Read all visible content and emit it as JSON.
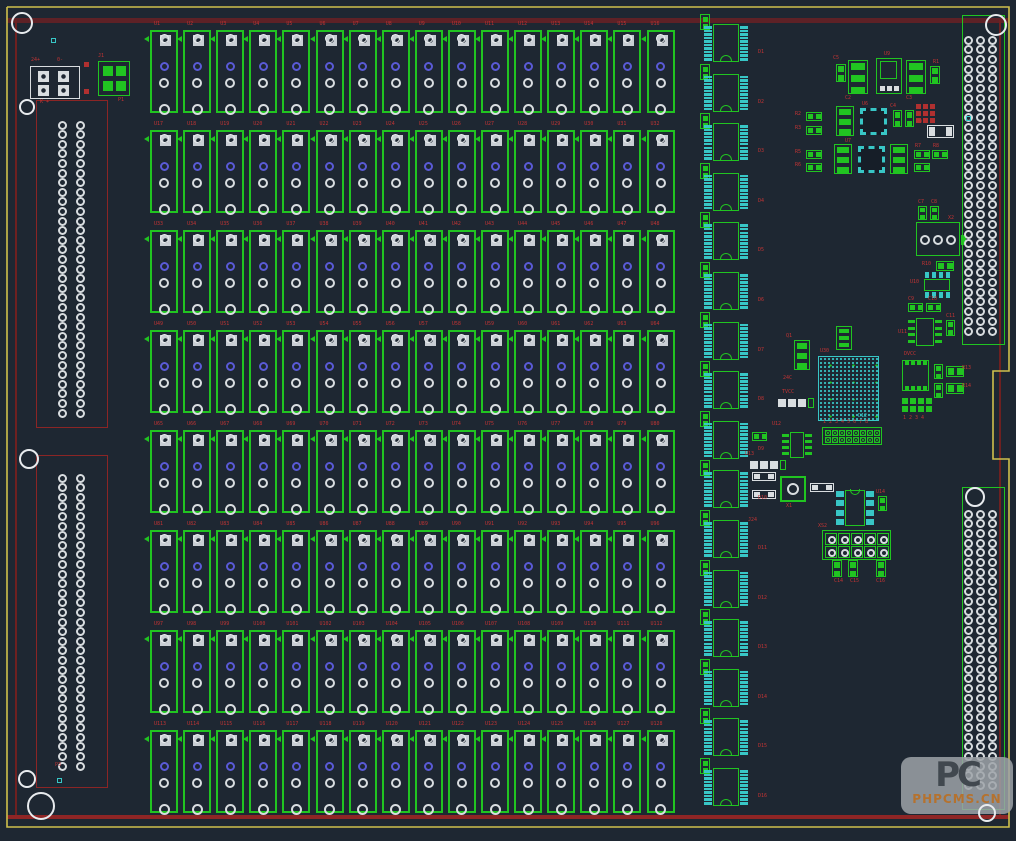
{
  "board": {
    "bg": "#1e2732",
    "outline_yellow": "#cfc04c",
    "outline_points": "7,7 1009,7 1009,371 993,371 993,459 1009,459 1009,827 7,827 7,7",
    "red_top": {
      "x": 7,
      "y": 18,
      "w": 1002,
      "h": 5,
      "color": "#5e2126"
    },
    "red_bottom": {
      "x": 7,
      "y": 815,
      "w": 1002,
      "h": 4,
      "color": "#8f2525"
    },
    "red_left": {
      "x": 15,
      "y": 20,
      "w": 2,
      "h": 795,
      "color": "#6e2020"
    },
    "red_right": {
      "x": 999,
      "y": 20,
      "w": 2,
      "h": 795,
      "color": "#6e2020"
    }
  },
  "colors": {
    "green": "#21c421",
    "cyan": "#38c6c6",
    "white": "#d9dde0",
    "blue": "#5a5ad6",
    "redline": "#8b2525",
    "label": "#c03434",
    "padgray": "#c9ced4"
  },
  "relays": {
    "x0": 150,
    "y0": 30,
    "dx": 33.1,
    "dy": 100,
    "w": 28,
    "h": 83,
    "cols": 16,
    "refs": [
      "U1",
      "U2",
      "U3",
      "U4",
      "U5",
      "U6",
      "U7",
      "U8",
      "U9",
      "U10",
      "U11",
      "U12",
      "U13",
      "U14",
      "U15",
      "U16",
      "U17",
      "U18",
      "U19",
      "U20",
      "U21",
      "U22",
      "U23",
      "U24",
      "U25",
      "U26",
      "U27",
      "U28",
      "U29",
      "U30",
      "U31",
      "U32",
      "U33",
      "U34",
      "U35",
      "U36",
      "U37",
      "U38",
      "U39",
      "U40",
      "U41",
      "U42",
      "U43",
      "U44",
      "U45",
      "U46",
      "U47",
      "U48",
      "U49",
      "U50",
      "U51",
      "U52",
      "U53",
      "U54",
      "U55",
      "U56",
      "U57",
      "U58",
      "U59",
      "U60",
      "U61",
      "U62",
      "U63",
      "U64",
      "U65",
      "U66",
      "U67",
      "U68",
      "U69",
      "U70",
      "U71",
      "U72",
      "U73",
      "U74",
      "U75",
      "U76",
      "U77",
      "U78",
      "U79",
      "U80",
      "U81",
      "U82",
      "U83",
      "U84",
      "U85",
      "U86",
      "U87",
      "U88",
      "U89",
      "U90",
      "U91",
      "U92",
      "U93",
      "U94",
      "U95",
      "U96",
      "U97",
      "U98",
      "U99",
      "U100",
      "U101",
      "U102",
      "U103",
      "U104",
      "U105",
      "U106",
      "U107",
      "U108",
      "U109",
      "U110",
      "U111",
      "U112",
      "U113",
      "U114",
      "U115",
      "U116",
      "U117",
      "U118",
      "U119",
      "U120",
      "U121",
      "U122",
      "U123",
      "U124",
      "U125",
      "U126",
      "U127",
      "U128"
    ]
  },
  "ics": {
    "x": 713,
    "y0": 24,
    "dy": 49.6,
    "bodyW": 26,
    "bodyH": 38,
    "padsPerSide": 10,
    "refs": [
      "D1",
      "D2",
      "D3",
      "D4",
      "D5",
      "D6",
      "D7",
      "D8",
      "D9",
      "D10",
      "D11",
      "D12",
      "D13",
      "D14",
      "D15",
      "D16"
    ]
  },
  "connectors": [
    {
      "name": "left-top",
      "x": 36,
      "y": 100,
      "w": 72,
      "h": 328,
      "outline": "#8b2525",
      "cols": [
        62,
        80
      ],
      "padY0": 125,
      "padDy": 9.6,
      "rows": 31
    },
    {
      "name": "left-bottom",
      "x": 36,
      "y": 455,
      "w": 72,
      "h": 333,
      "outline": "#8b2525",
      "cols": [
        62,
        80
      ],
      "padY0": 478,
      "padDy": 9.6,
      "rows": 31
    },
    {
      "name": "right-top",
      "x": 962,
      "y": 15,
      "w": 43,
      "h": 330,
      "outline": "#21c421",
      "cols": [
        968,
        980,
        992
      ],
      "padY0": 40,
      "padDy": 9.7,
      "rows": 31
    },
    {
      "name": "right-bottom",
      "x": 962,
      "y": 487,
      "w": 43,
      "h": 323,
      "outline": "#21c421",
      "cols": [
        968,
        980,
        992
      ],
      "padY0": 514,
      "padDy": 9.7,
      "rows": 29
    }
  ],
  "holes": [
    {
      "x": 22,
      "y": 23,
      "r": 11
    },
    {
      "x": 27,
      "y": 107,
      "r": 8
    },
    {
      "x": 29,
      "y": 459,
      "r": 10
    },
    {
      "x": 27,
      "y": 779,
      "r": 9
    },
    {
      "x": 41,
      "y": 806,
      "r": 14
    },
    {
      "x": 996,
      "y": 25,
      "r": 11
    },
    {
      "x": 975,
      "y": 497,
      "r": 10
    },
    {
      "x": 987,
      "y": 813,
      "r": 9
    }
  ],
  "dots": [
    {
      "x": 51,
      "y": 38
    },
    {
      "x": 966,
      "y": 116
    },
    {
      "x": 57,
      "y": 778
    }
  ],
  "parts": [
    {
      "t": "white4",
      "x": 30,
      "y": 66,
      "w": 50,
      "h": 33
    },
    {
      "t": "green4",
      "x": 98,
      "y": 61,
      "w": 32,
      "h": 35
    },
    {
      "t": "sq_r",
      "x": 84,
      "y": 62,
      "w": 5,
      "h": 5
    },
    {
      "t": "sq_r",
      "x": 84,
      "y": 89,
      "w": 5,
      "h": 5
    },
    {
      "t": "res2v",
      "x": 836,
      "y": 64,
      "w": 10,
      "h": 18
    },
    {
      "t": "sot3",
      "x": 848,
      "y": 60,
      "w": 20,
      "h": 34
    },
    {
      "t": "reg",
      "x": 876,
      "y": 58,
      "w": 26,
      "h": 36
    },
    {
      "t": "sot3",
      "x": 906,
      "y": 60,
      "w": 20,
      "h": 34
    },
    {
      "t": "res2v",
      "x": 930,
      "y": 66,
      "w": 10,
      "h": 18
    },
    {
      "t": "res2h",
      "x": 806,
      "y": 112,
      "w": 16,
      "h": 9
    },
    {
      "t": "res2h",
      "x": 806,
      "y": 126,
      "w": 16,
      "h": 9
    },
    {
      "t": "sot3",
      "x": 836,
      "y": 106,
      "w": 18,
      "h": 30
    },
    {
      "t": "qfnc",
      "x": 860,
      "y": 108,
      "w": 27,
      "h": 27
    },
    {
      "t": "res2v",
      "x": 893,
      "y": 110,
      "w": 9,
      "h": 17
    },
    {
      "t": "res2v",
      "x": 905,
      "y": 110,
      "w": 9,
      "h": 17
    },
    {
      "t": "sqgrid_r",
      "x": 916,
      "y": 104,
      "cols": 3,
      "rows": 3,
      "cell": 7
    },
    {
      "t": "whiteh",
      "x": 927,
      "y": 125,
      "w": 27,
      "h": 13
    },
    {
      "t": "res2h",
      "x": 806,
      "y": 150,
      "w": 16,
      "h": 9
    },
    {
      "t": "res2h",
      "x": 806,
      "y": 163,
      "w": 16,
      "h": 9
    },
    {
      "t": "sot3",
      "x": 834,
      "y": 144,
      "w": 18,
      "h": 30
    },
    {
      "t": "qfnc",
      "x": 858,
      "y": 146,
      "w": 27,
      "h": 27
    },
    {
      "t": "sot3",
      "x": 890,
      "y": 144,
      "w": 18,
      "h": 30
    },
    {
      "t": "res2h",
      "x": 914,
      "y": 150,
      "w": 16,
      "h": 9
    },
    {
      "t": "res2h",
      "x": 932,
      "y": 150,
      "w": 16,
      "h": 9
    },
    {
      "t": "res2h",
      "x": 914,
      "y": 163,
      "w": 16,
      "h": 9
    },
    {
      "t": "res2v",
      "x": 918,
      "y": 206,
      "w": 9,
      "h": 14
    },
    {
      "t": "res2v",
      "x": 930,
      "y": 206,
      "w": 9,
      "h": 14
    },
    {
      "t": "term3",
      "x": 916,
      "y": 222,
      "w": 44,
      "h": 34
    },
    {
      "t": "res2h",
      "x": 936,
      "y": 261,
      "w": 18,
      "h": 10
    },
    {
      "t": "soicch",
      "x": 922,
      "y": 272,
      "w": 30,
      "h": 26
    },
    {
      "t": "res2h",
      "x": 908,
      "y": 303,
      "w": 15,
      "h": 9
    },
    {
      "t": "res2h",
      "x": 926,
      "y": 303,
      "w": 15,
      "h": 9
    },
    {
      "t": "soicg",
      "x": 908,
      "y": 316,
      "w": 34,
      "h": 32
    },
    {
      "t": "res2v",
      "x": 946,
      "y": 320,
      "w": 9,
      "h": 16
    },
    {
      "t": "sot3",
      "x": 836,
      "y": 326,
      "w": 16,
      "h": 24
    },
    {
      "t": "sot3",
      "x": 794,
      "y": 340,
      "w": 16,
      "h": 30
    },
    {
      "t": "white3",
      "x": 778,
      "y": 396,
      "w": 34,
      "h": 17
    },
    {
      "t": "bga",
      "x": 818,
      "y": 356,
      "w": 61,
      "h": 65
    },
    {
      "t": "qfnv",
      "x": 902,
      "y": 360,
      "w": 27,
      "h": 31
    },
    {
      "t": "res2v",
      "x": 934,
      "y": 364,
      "w": 9,
      "h": 15
    },
    {
      "t": "res2h",
      "x": 946,
      "y": 366,
      "w": 18,
      "h": 11
    },
    {
      "t": "res2v",
      "x": 934,
      "y": 383,
      "w": 9,
      "h": 15
    },
    {
      "t": "res2h",
      "x": 946,
      "y": 383,
      "w": 18,
      "h": 11
    },
    {
      "t": "sqgrid_g",
      "x": 902,
      "y": 398,
      "cols": 4,
      "rows": 2,
      "cell": 8
    },
    {
      "t": "res2h",
      "x": 752,
      "y": 432,
      "w": 15,
      "h": 9
    },
    {
      "t": "soicg",
      "x": 782,
      "y": 430,
      "w": 30,
      "h": 30
    },
    {
      "t": "hdrcirc",
      "x": 822,
      "y": 427,
      "cols": 8,
      "rows": 2,
      "cell": 7
    },
    {
      "t": "white3",
      "x": 750,
      "y": 458,
      "w": 34,
      "h": 15
    },
    {
      "t": "whiteh",
      "x": 752,
      "y": 472,
      "w": 24,
      "h": 9
    },
    {
      "t": "whiteh",
      "x": 752,
      "y": 490,
      "w": 24,
      "h": 9
    },
    {
      "t": "xtal",
      "x": 780,
      "y": 476,
      "w": 26,
      "h": 26
    },
    {
      "t": "whiteh",
      "x": 810,
      "y": 483,
      "w": 24,
      "h": 9
    },
    {
      "t": "dipc",
      "x": 836,
      "y": 489,
      "w": 38,
      "h": 38
    },
    {
      "t": "res2v",
      "x": 878,
      "y": 496,
      "w": 9,
      "h": 15
    },
    {
      "t": "hdrcirc",
      "x": 822,
      "y": 530,
      "cols": 5,
      "rows": 2,
      "cell": 13
    },
    {
      "t": "res2v",
      "x": 832,
      "y": 560,
      "w": 10,
      "h": 17
    },
    {
      "t": "res2v",
      "x": 848,
      "y": 560,
      "w": 10,
      "h": 17
    },
    {
      "t": "res2v",
      "x": 876,
      "y": 560,
      "w": 10,
      "h": 17
    }
  ],
  "labels": [
    {
      "x": 31,
      "y": 58,
      "text": "24+"
    },
    {
      "x": 57,
      "y": 58,
      "text": "0-"
    },
    {
      "x": 40,
      "y": 100,
      "text": "K +"
    },
    {
      "x": 98,
      "y": 54,
      "text": "J1"
    },
    {
      "x": 118,
      "y": 98,
      "text": "P1"
    },
    {
      "x": 833,
      "y": 56,
      "text": "C5"
    },
    {
      "x": 884,
      "y": 52,
      "text": "U9"
    },
    {
      "x": 933,
      "y": 60,
      "text": "R1"
    },
    {
      "x": 845,
      "y": 96,
      "text": "C2"
    },
    {
      "x": 906,
      "y": 96,
      "text": "C3"
    },
    {
      "x": 795,
      "y": 112,
      "text": "R2"
    },
    {
      "x": 795,
      "y": 126,
      "text": "R3"
    },
    {
      "x": 862,
      "y": 102,
      "text": "U6"
    },
    {
      "x": 890,
      "y": 104,
      "text": "C4"
    },
    {
      "x": 795,
      "y": 150,
      "text": "R5"
    },
    {
      "x": 795,
      "y": 163,
      "text": "R6"
    },
    {
      "x": 845,
      "y": 139,
      "text": "U7"
    },
    {
      "x": 915,
      "y": 144,
      "text": "R7"
    },
    {
      "x": 933,
      "y": 144,
      "text": "R8"
    },
    {
      "x": 916,
      "y": 120,
      "text": "R9"
    },
    {
      "x": 918,
      "y": 200,
      "text": "C7"
    },
    {
      "x": 931,
      "y": 200,
      "text": "C8"
    },
    {
      "x": 948,
      "y": 216,
      "text": "X2"
    },
    {
      "x": 922,
      "y": 262,
      "text": "R10"
    },
    {
      "x": 910,
      "y": 280,
      "text": "U10"
    },
    {
      "x": 908,
      "y": 297,
      "text": "C9"
    },
    {
      "x": 928,
      "y": 297,
      "text": "C10"
    },
    {
      "x": 898,
      "y": 330,
      "text": "U11"
    },
    {
      "x": 946,
      "y": 314,
      "text": "C11"
    },
    {
      "x": 786,
      "y": 334,
      "text": "Q1"
    },
    {
      "x": 783,
      "y": 376,
      "text": "24C"
    },
    {
      "x": 782,
      "y": 390,
      "text": "TVCC"
    },
    {
      "x": 820,
      "y": 349,
      "text": "U30"
    },
    {
      "x": 904,
      "y": 352,
      "text": "DVCC"
    },
    {
      "x": 903,
      "y": 416,
      "text": "1 2 3 4"
    },
    {
      "x": 823,
      "y": 420,
      "text": "1 2 3 4 5 6 7 8"
    },
    {
      "x": 772,
      "y": 422,
      "text": "U12"
    },
    {
      "x": 745,
      "y": 452,
      "text": "U13"
    },
    {
      "x": 786,
      "y": 504,
      "text": "X1"
    },
    {
      "x": 876,
      "y": 490,
      "text": "U14"
    },
    {
      "x": 818,
      "y": 524,
      "text": "XS2"
    },
    {
      "x": 834,
      "y": 579,
      "text": "C14"
    },
    {
      "x": 850,
      "y": 579,
      "text": "C15"
    },
    {
      "x": 876,
      "y": 579,
      "text": "C16"
    },
    {
      "x": 748,
      "y": 518,
      "text": "J24"
    },
    {
      "x": 962,
      "y": 366,
      "text": "R13"
    },
    {
      "x": 962,
      "y": 384,
      "text": "R14"
    },
    {
      "x": 55,
      "y": 763,
      "text": "P3"
    }
  ],
  "cyan_labels": [
    {
      "x": 858,
      "y": 414,
      "text": "D12"
    }
  ],
  "watermark": {
    "logo": "PC",
    "text": "PHPCMS.CN"
  }
}
